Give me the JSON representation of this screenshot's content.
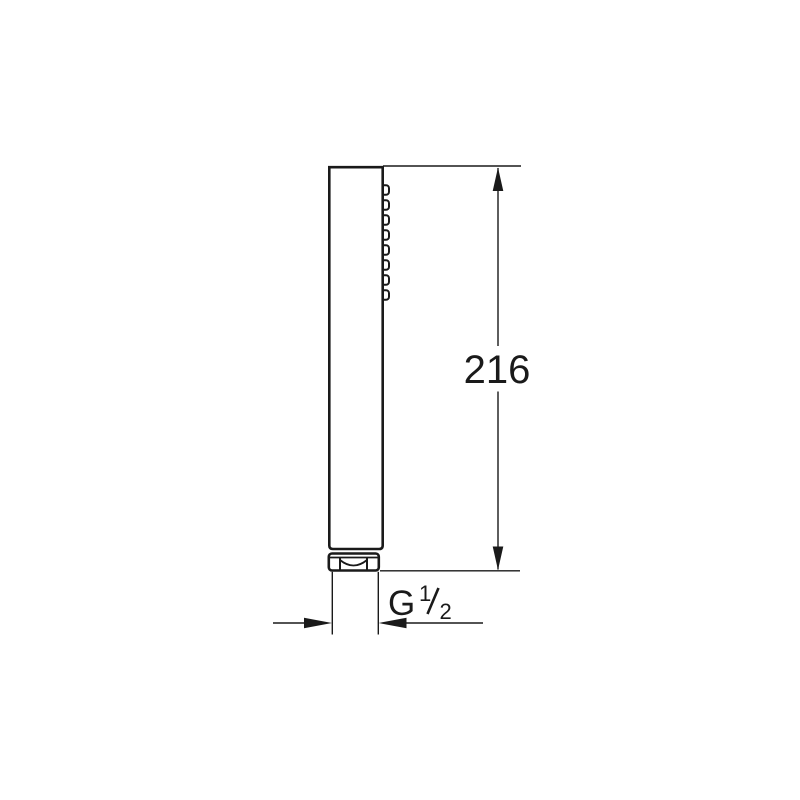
{
  "drawing": {
    "type": "technical-dimension-drawing",
    "subject": "stick hand shower, side elevation with connector nut",
    "colors": {
      "line": "#1a1a1a",
      "background": "#ffffff"
    },
    "nozzle_count": 8,
    "dimensions": {
      "height": {
        "value": "216",
        "orientation": "vertical"
      },
      "thread": {
        "label": "G 1/2",
        "prefix": "G",
        "numerator": "1",
        "denominator": "2",
        "orientation": "horizontal"
      }
    }
  }
}
